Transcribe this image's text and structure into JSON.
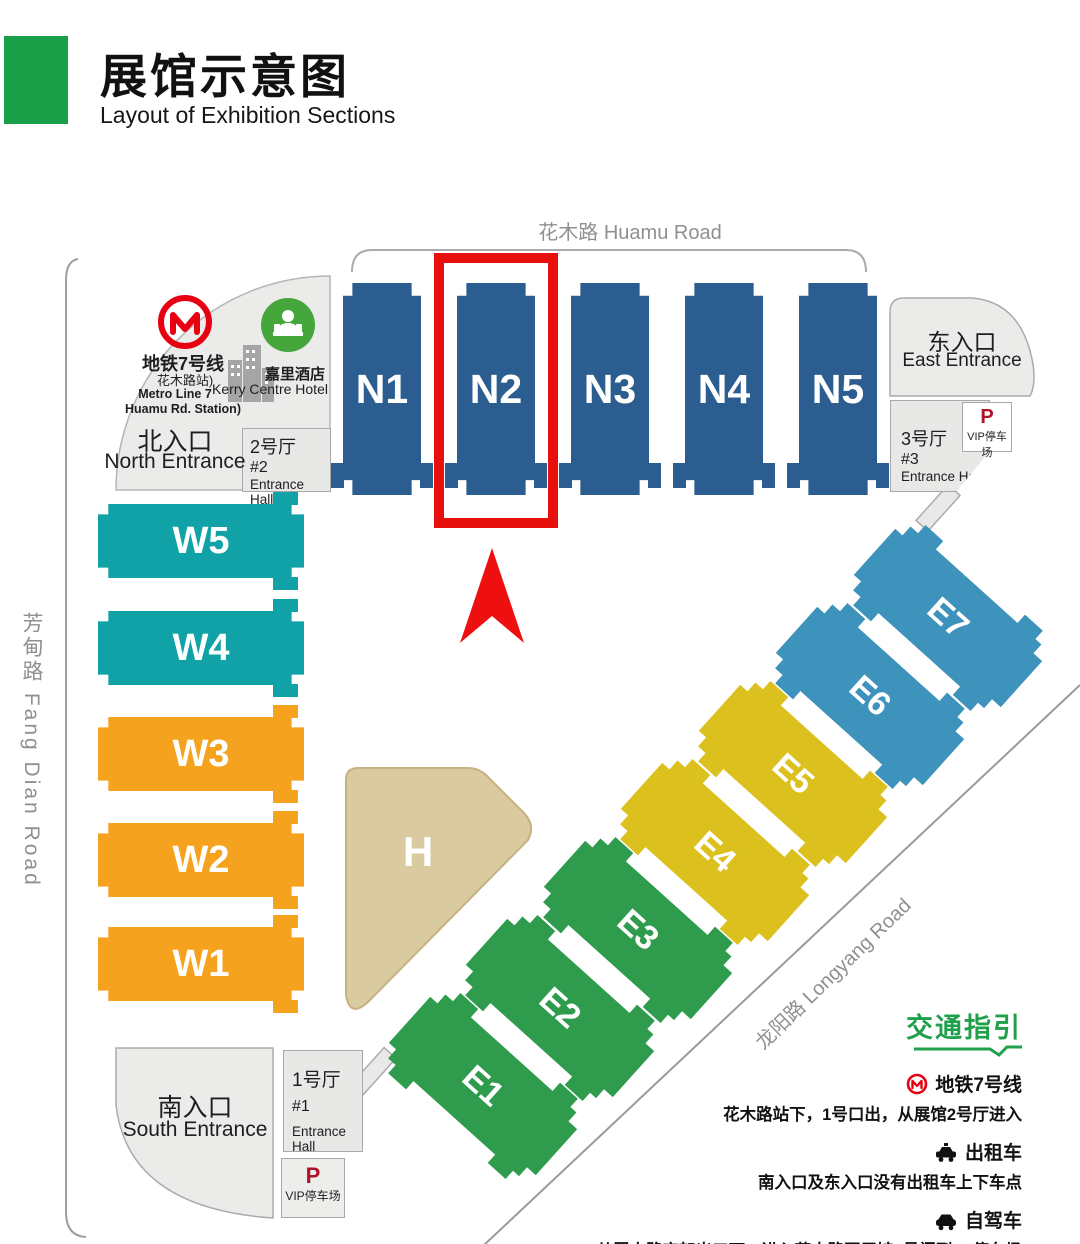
{
  "header": {
    "title": "展馆示意图",
    "subtitle": "Layout of Exhibition Sections"
  },
  "roads": {
    "huamu": "花木路 Huamu Road",
    "fangdian": "芳甸路 Fang Dian Road",
    "longyang": "龙阳路  Longyang Road"
  },
  "halls": {
    "north": [
      "N1",
      "N2",
      "N3",
      "N4",
      "N5"
    ],
    "west": [
      "W5",
      "W4",
      "W3",
      "W2",
      "W1"
    ],
    "east": [
      "E1",
      "E2",
      "E3",
      "E4",
      "E5",
      "E6",
      "E7"
    ],
    "h": "H"
  },
  "north_area": {
    "metro_line": "地铁7号线",
    "station": "花木路站)",
    "metro_line_en": "Metro Line 7",
    "station_en": "Huamu Rd. Station)",
    "hotel": "嘉里酒店",
    "hotel_en": "Kerry Centre Hotel",
    "entrance": "北入口",
    "entrance_en": "North Entrance",
    "hall_name": "2号厅",
    "hall_num": "#2",
    "hall_en": "Entrance Hall"
  },
  "east_area": {
    "entrance": "东入口",
    "entrance_en": "East Entrance",
    "hall_name": "3号厅",
    "hall_num": "#3",
    "hall_en": "Entrance Hall",
    "parking_p": "P",
    "parking": "VIP停车场"
  },
  "south_area": {
    "entrance": "南入口",
    "entrance_en": "South Entrance",
    "hall_name": "1号厅",
    "hall_num": "#1",
    "hall_en": "Entrance Hall",
    "parking_p": "P",
    "parking": "VIP停车场"
  },
  "guide": {
    "title": "交通指引",
    "items": [
      {
        "icon": "metro-icon",
        "label": "地铁7号线",
        "desc": "花木路站下，1号口出，从展馆2号厅进入"
      },
      {
        "icon": "taxi-icon",
        "label": "出租车",
        "desc": "南入口及东入口没有出租车上下车点"
      },
      {
        "icon": "car-icon",
        "label": "自驾车",
        "desc": "从罗山路高架出口下，进入花木路至展馆7号门到P1停车场"
      }
    ]
  },
  "colors": {
    "north_halls": "#2B5D90",
    "west_halls_teal": "#10A2A6",
    "west_halls_orange": "#F5A31F",
    "east_halls_green": "#2F9C4D",
    "east_halls_yellow": "#DCC01E",
    "east_halls_blue": "#3D93BB",
    "h_hall": "#DACAA0",
    "highlight_red": "#E8100C",
    "header_green": "#1BA04A",
    "guide_green": "#1FA04B",
    "metro_red": "#E60012"
  }
}
